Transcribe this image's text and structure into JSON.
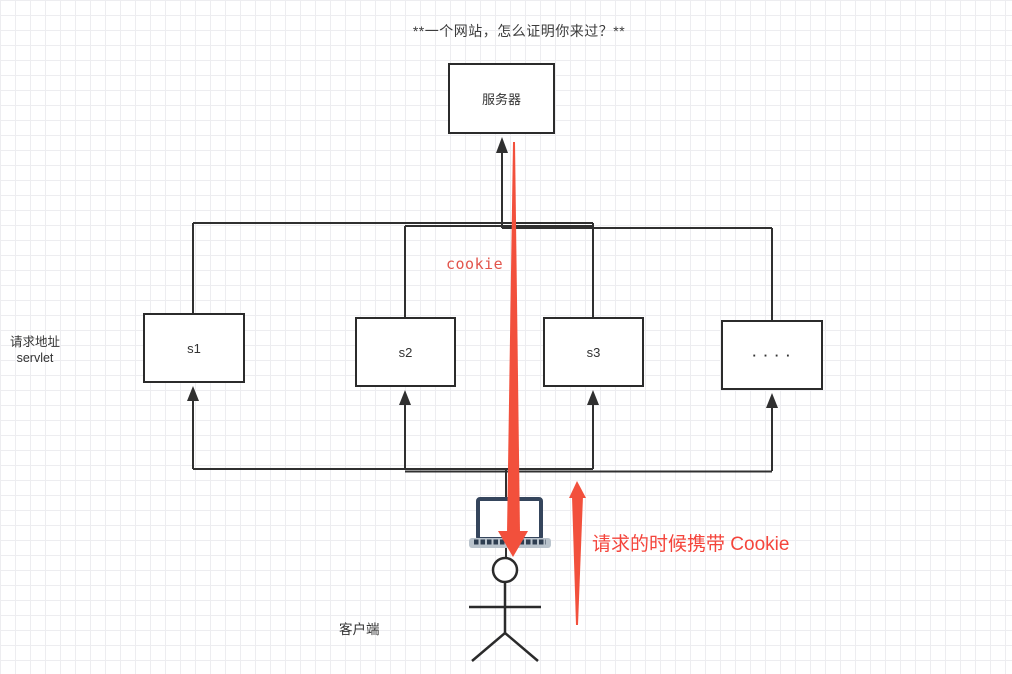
{
  "title": "**一个网站，怎么证明你来过？**",
  "diagram": {
    "server": {
      "label": "服务器"
    },
    "servlets": [
      {
        "label": "s1"
      },
      {
        "label": "s2"
      },
      {
        "label": "s3"
      },
      {
        "label": "∙ ∙ ∙ ∙"
      }
    ],
    "left_label": {
      "line1": "请求地址",
      "line2": "servlet"
    },
    "cookie_label": "cookie",
    "annotation": "请求的时候携带 Cookie",
    "client_label": "客户端",
    "colors": {
      "accent_red": "#f2503c",
      "connector_dark": "#303030",
      "laptop_bezel": "#35455c",
      "laptop_base": "#b9c3cc"
    }
  }
}
